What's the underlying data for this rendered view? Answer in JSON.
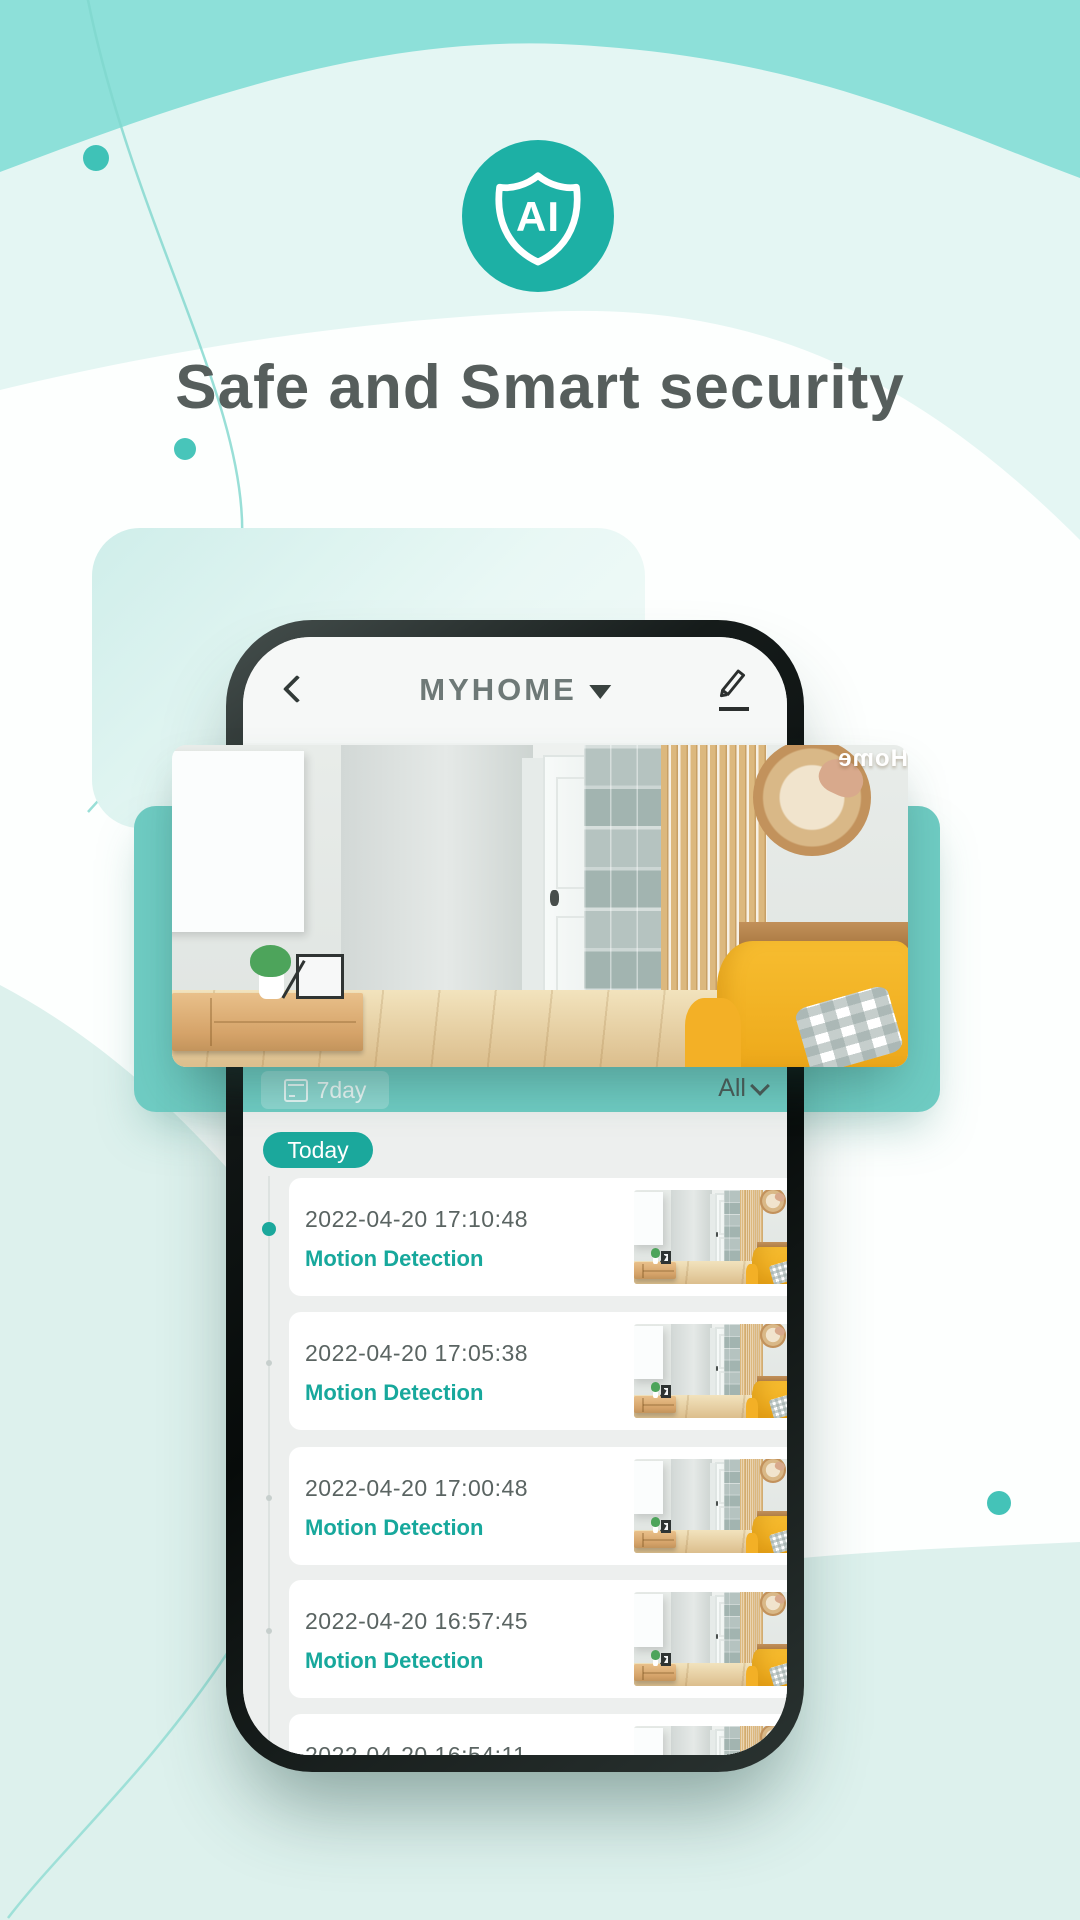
{
  "page": {
    "heading": "Safe and Smart security",
    "logo_text": "AI"
  },
  "colors": {
    "accent_teal": "#1ba89c",
    "panel_teal": "#6fccc3",
    "wave_teal": "#8de0d9",
    "pale_mint": "#e4f6f3",
    "heading_gray": "#565e5c",
    "sofa_yellow": "#f3b429"
  },
  "icons": {
    "logo_shield": "shield-icon",
    "back": "chevron-left-icon",
    "title_caret": "caret-down-icon",
    "edit": "pencil-icon",
    "range_calendar": "calendar-icon",
    "filter_caret": "chevron-down-icon"
  },
  "phone": {
    "navbar": {
      "title": "MYHOME"
    },
    "filter_bar": {
      "range_button": "7day",
      "filter_dropdown": "All"
    },
    "timeline": {
      "day_label": "Today"
    },
    "events": [
      {
        "time": "2022-04-20 17:10:48",
        "type": "Motion Detection"
      },
      {
        "time": "2022-04-20 17:05:38",
        "type": "Motion Detection"
      },
      {
        "time": "2022-04-20 17:00:48",
        "type": "Motion Detection"
      },
      {
        "time": "2022-04-20 16:57:45",
        "type": "Motion Detection"
      },
      {
        "time": "2022-04-20 16:54:11",
        "type": ""
      }
    ]
  },
  "scene": {
    "home_decor_text": "Home"
  }
}
